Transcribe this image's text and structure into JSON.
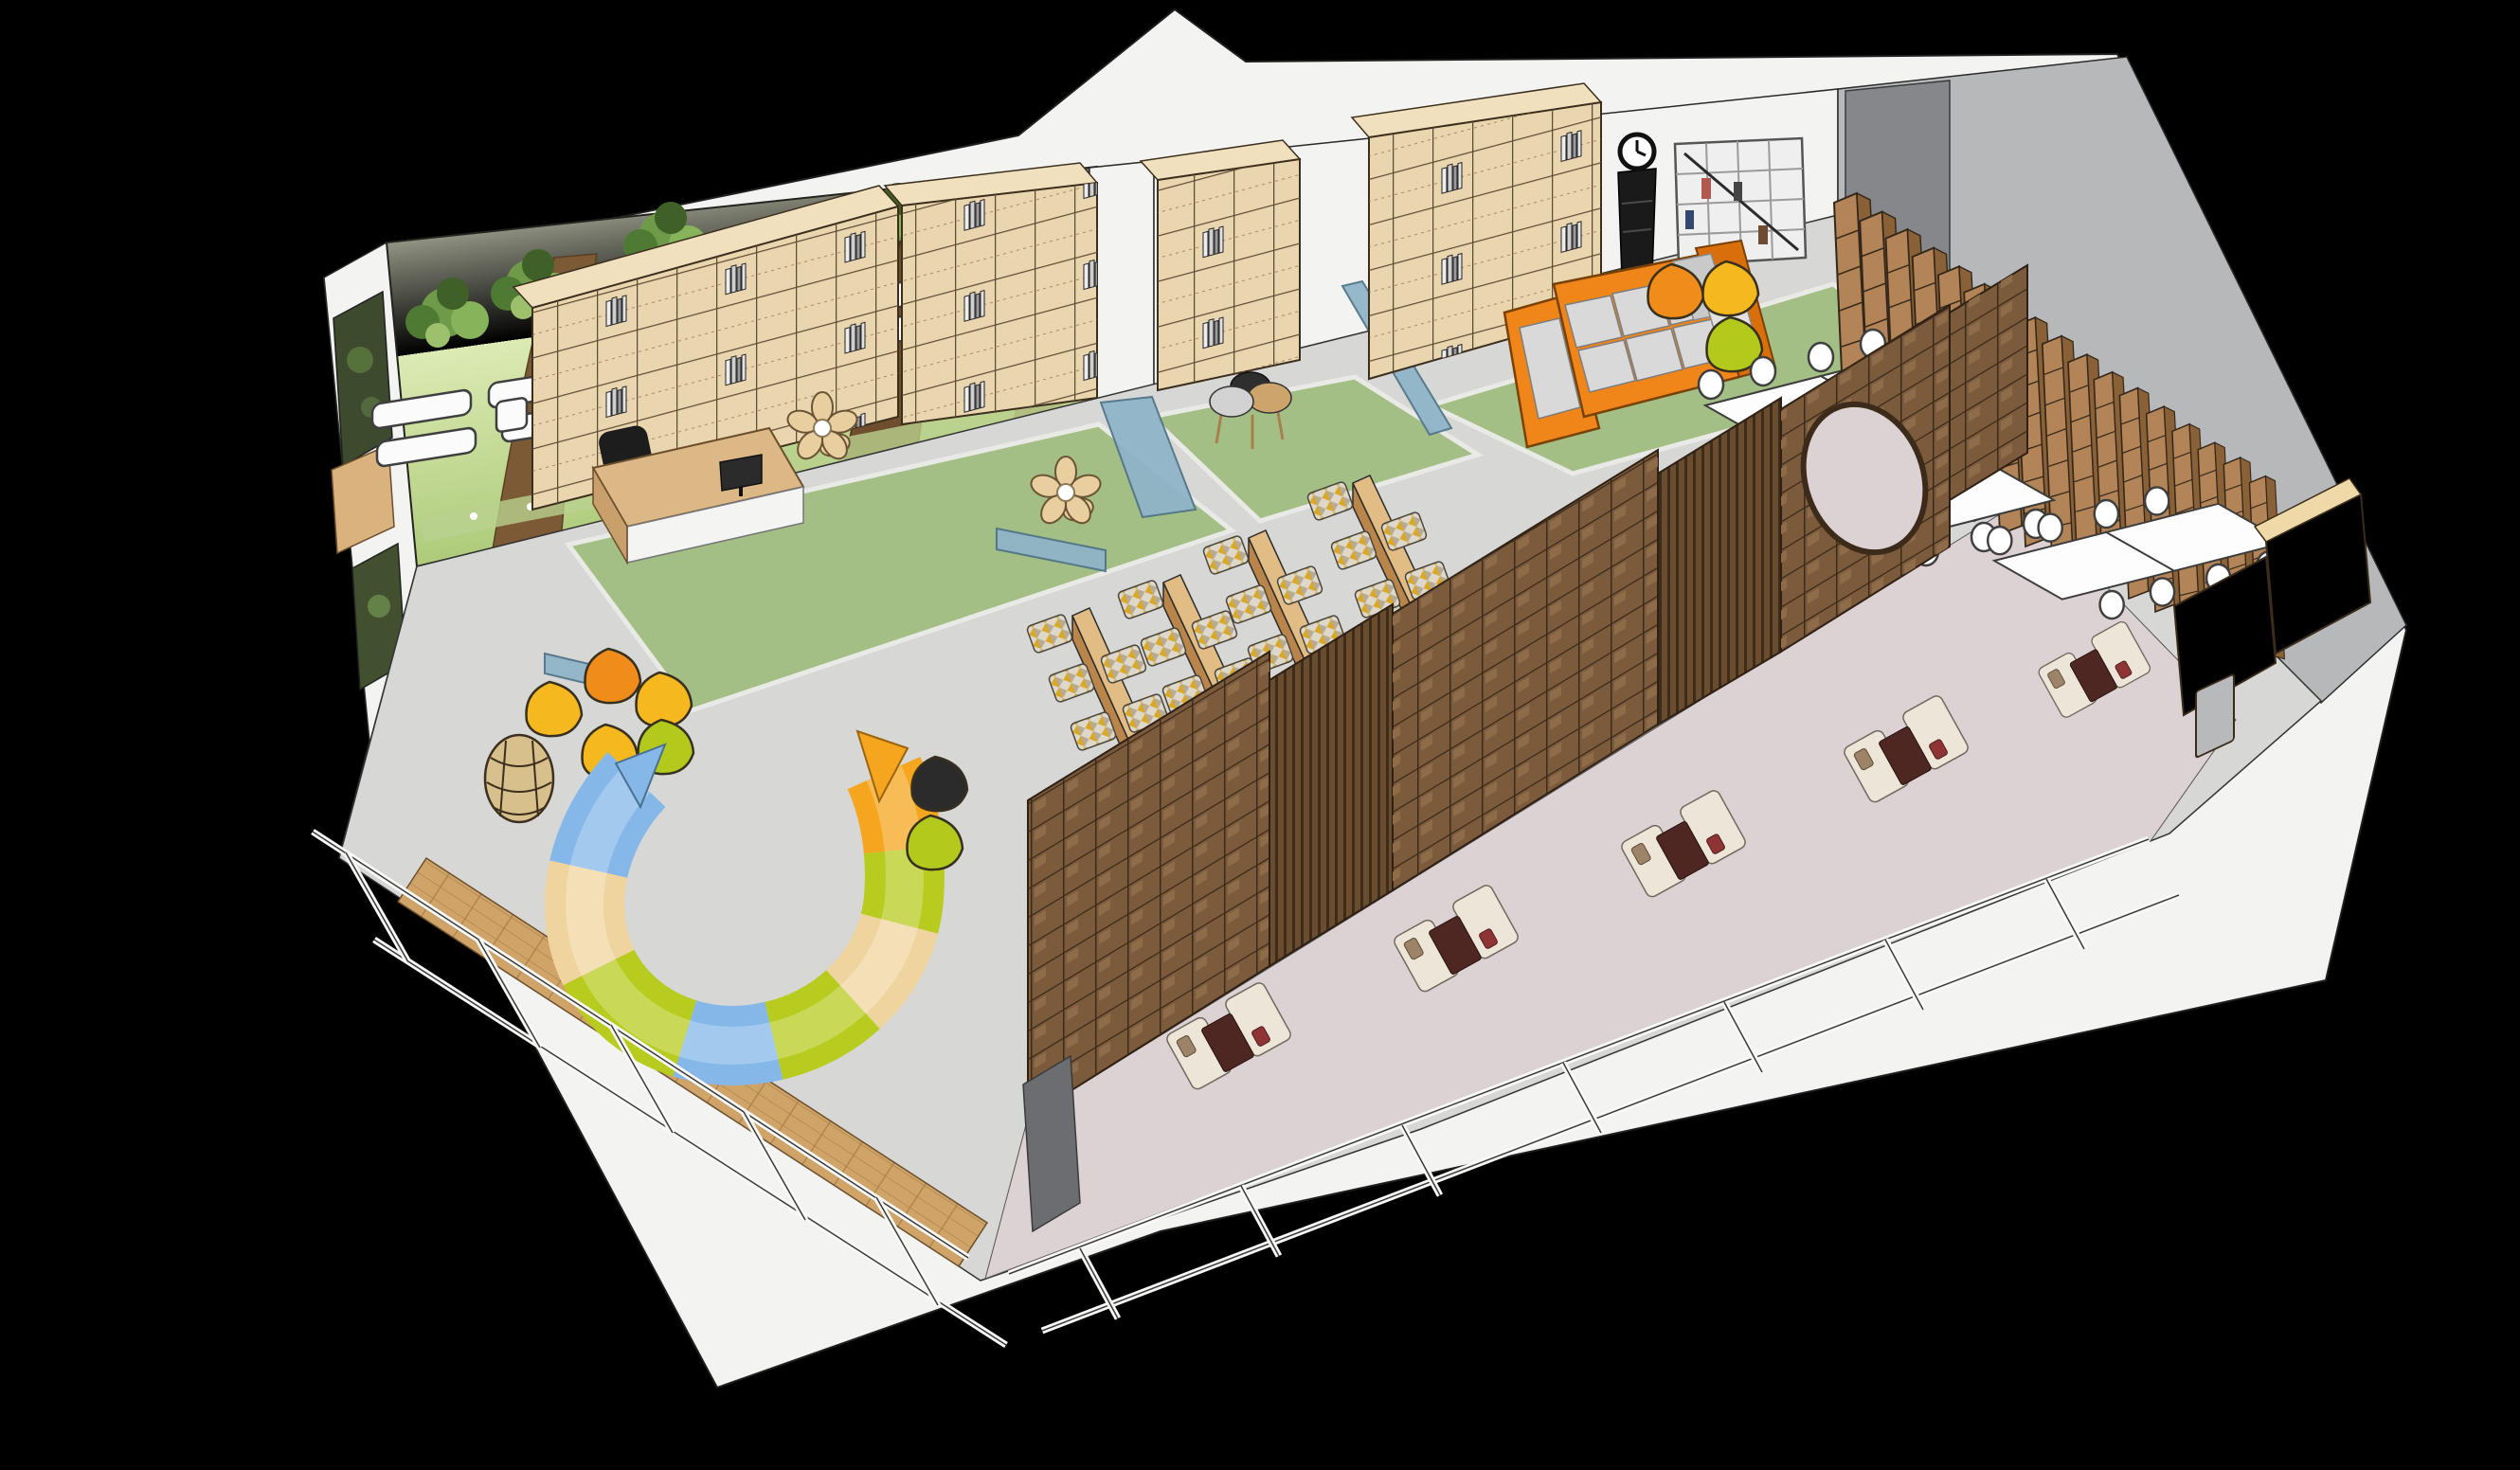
{
  "scene": {
    "type": "3d-isometric-cutaway-rendering",
    "subject": "Children's library / reading-room interior floor plan viewed from above",
    "background": "#000000",
    "style": "SketchUp-like architectural render"
  },
  "palette": {
    "bg": "#000000",
    "wall_white": "#f3f3f1",
    "wall_gray": "#b6b8ba",
    "wall_gray_dark": "#85878a",
    "floor_gray": "#d7d7d5",
    "floor_wood": "#d0a468",
    "lounge_floor": "#dcd2d3",
    "carpet_green": "#a3bf85",
    "mural_light": "#eef3d8",
    "mural_green": "#a9c874",
    "trunk_brown": "#7c5a36",
    "shelf_wood": "#e9d5ae",
    "shelf_wood_top": "#f0e0bd",
    "stack_wood": "#b28457",
    "divider_brown": "#7c5a3c",
    "cabinet_tan": "#e2c globalization693",
    "glass_blue": "#8fb4c9",
    "sofa_orange": "#f08519",
    "cushion_gray": "#d9d9d9",
    "pouf_orange": "#f08c19",
    "pouf_yellow": "#f5b81e",
    "pouf_green": "#b3c91c",
    "pouf_black": "#2b2b2b",
    "bench_blue": "#85b8e8",
    "bench_tan": "#f0d49e",
    "bench_green": "#b7cc1f",
    "bench_orange": "#f5a61e",
    "table_white": "#fdfdfd",
    "lounge_sofa": "#ece5d8",
    "lounge_table": "#4f2722",
    "clock_black": "#1a1a1a"
  },
  "labels": {
    "room": "library reading room cutaway",
    "mural": "forest mural wall with white display shelves",
    "reception": "reception desk with monitor and office chair",
    "bookshelves": "cube bookshelf wall units",
    "carpets": "green carpet zones with glass partitions",
    "sofa_zone": "orange sectional sofa lounge with poufs, clock and cube shelf",
    "tables": "white study tables with chairs",
    "stacks": "row of tall wooden book stacks",
    "benches": "low reading benches with patterned floor cushions",
    "ubench": "U-shaped multicolour play bench",
    "dividers": "dark wood open-shelf dividers with slat screens and moon gate",
    "lounge": "glazed lounge booths with cream sofas and dark tables",
    "glazing": "white framed window walls",
    "wicker": "rattan lounge chair",
    "flower": "petal floor-cushion set"
  },
  "counts": {
    "book_stacks": 17,
    "reading_benches": 4,
    "bench_cushions": 24,
    "table_clusters": 3,
    "chairs_per_cluster": 8,
    "wall_display_boxes": 14,
    "lounge_booths": 5,
    "poufs": 10,
    "green_carpet_zones": 3,
    "glass_partitions": 2
  }
}
